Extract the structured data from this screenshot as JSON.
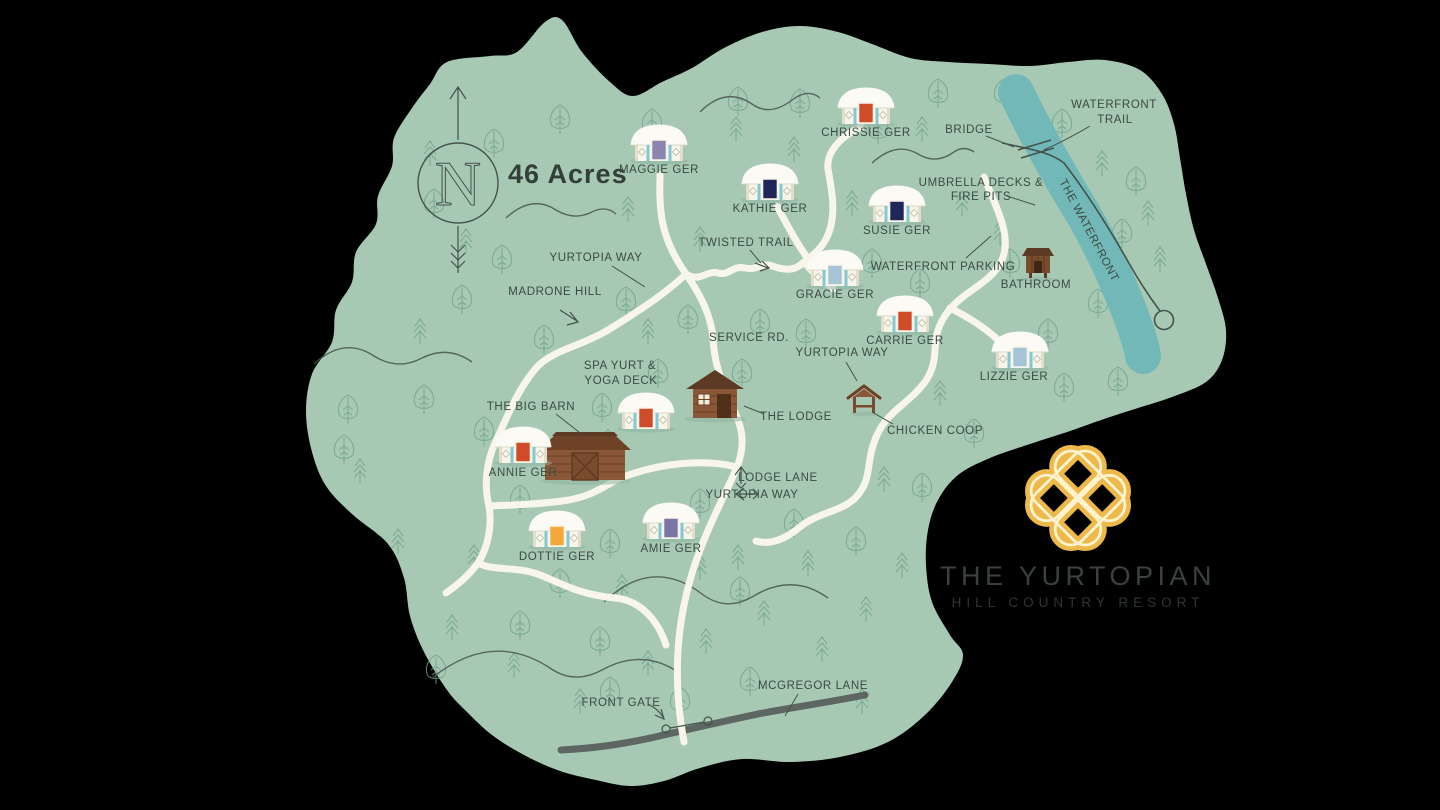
{
  "canvas": {
    "land_color": "#a7c9b3",
    "water_color": "#73b8b8",
    "road_color": "#f8f5ea",
    "paved_road_color": "#5d6662",
    "label_color": "#3b4a42",
    "logo_gold": "#ecb94a"
  },
  "header": {
    "acreage": "46 Acres",
    "compass_letter": "N"
  },
  "yurts": [
    {
      "name": "MAGGIE GER",
      "door_color": "#8b84ae"
    },
    {
      "name": "CHRISSIE GER",
      "door_color": "#d04b28"
    },
    {
      "name": "KATHIE GER",
      "door_color": "#20265a"
    },
    {
      "name": "SUSIE GER",
      "door_color": "#20265a"
    },
    {
      "name": "GRACIE GER",
      "door_color": "#a5c4d5"
    },
    {
      "name": "CARRIE GER",
      "door_color": "#d04b28"
    },
    {
      "name": "LIZZIE GER",
      "door_color": "#a5c4d5"
    },
    {
      "name": "ANNIE GER",
      "door_color": "#d04b28"
    },
    {
      "name": "SPA YURT & YOGA DECK",
      "door_color": "#d04b28",
      "label_line1": "SPA YURT &",
      "label_line2": "YOGA DECK"
    },
    {
      "name": "DOTTIE GER",
      "door_color": "#f3a93c"
    },
    {
      "name": "AMIE GER",
      "door_color": "#7b74a7"
    }
  ],
  "places": {
    "bathroom": "BATHROOM",
    "the_lodge": "THE LODGE",
    "chicken_coop": "CHICKEN COOP",
    "big_barn": "THE BIG BARN",
    "front_gate": "FRONT GATE"
  },
  "trails": {
    "waterfront_trail_line1": "WATERFRONT",
    "waterfront_trail_line2": "TRAIL",
    "bridge": "BRIDGE",
    "umbrella_line1": "UMBRELLA DECKS &",
    "umbrella_line2": "FIRE PITS",
    "the_waterfront": "THE WATERFRONT",
    "twisted_trail": "TWISTED TRAIL",
    "waterfront_parking": "WATERFRONT PARKING",
    "yurtopia_way_upper": "YURTOPIA WAY",
    "yurtopia_way_mid": "YURTOPIA WAY",
    "yurtopia_way_lower": "YURTOPIA WAY",
    "madrone_hill": "MADRONE HILL",
    "service_rd": "SERVICE RD.",
    "lodge_lane": "LODGE LANE",
    "mcgregor_lane": "MCGREGOR LANE"
  },
  "logo": {
    "title": "THE YURTOPIAN",
    "subtitle": "HILL COUNTRY RESORT"
  }
}
